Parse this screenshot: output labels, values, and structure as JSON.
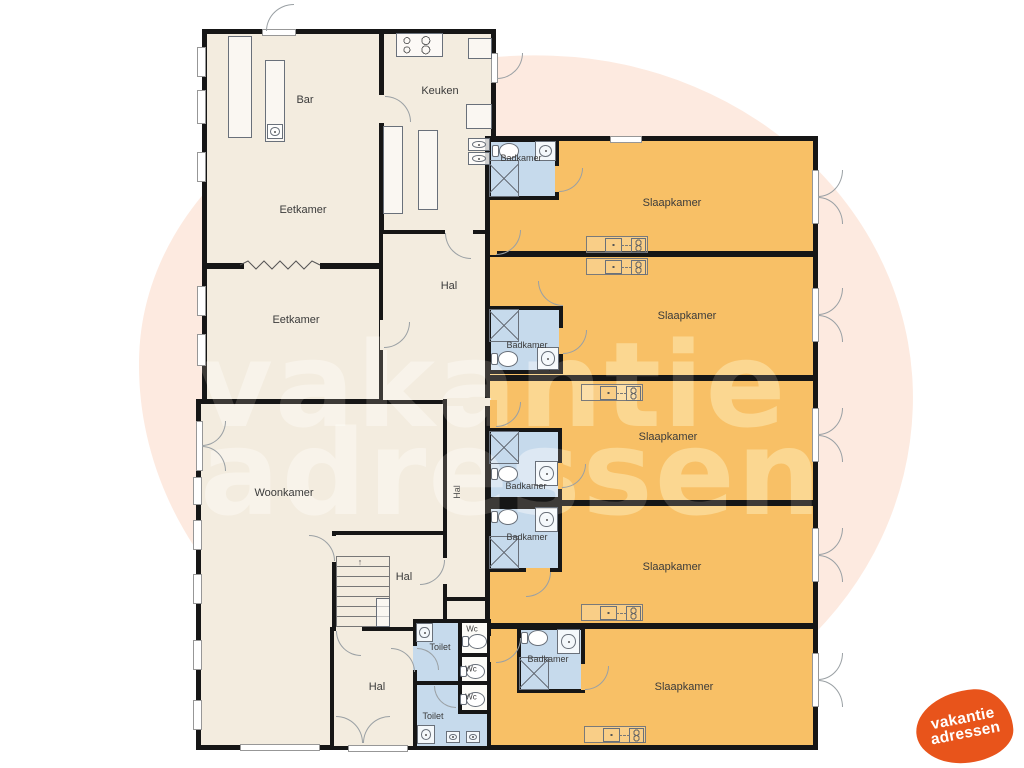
{
  "watermark": {
    "line1": "vakantie",
    "line2": "adressen"
  },
  "logo": {
    "line1": "vakantie",
    "line2": "adressen"
  },
  "colors": {
    "wall": "#161616",
    "floor": "#f3ecdf",
    "bedroom": "#f8c066",
    "bathroom": "#c6daec",
    "blob": "#fdeae0",
    "watermark": "#fff6ec",
    "logo": "#e8541b"
  },
  "rooms": {
    "bar": "Bar",
    "keuken": "Keuken",
    "eetkamer_boven": "Eetkamer",
    "eetkamer_onder": "Eetkamer",
    "woonkamer": "Woonkamer",
    "hal_centraal": "Hal",
    "hal_gang": "Hal",
    "hal_trap": "Hal",
    "hal_onder": "Hal",
    "toilet_boven": "Toilet",
    "toilet_onder": "Toilet"
  },
  "bedrooms": [
    {
      "label": "Slaapkamer"
    },
    {
      "label": "Slaapkamer"
    },
    {
      "label": "Slaapkamer"
    },
    {
      "label": "Slaapkamer"
    },
    {
      "label": "Slaapkamer"
    }
  ],
  "bathrooms": [
    {
      "label": "Badkamer"
    },
    {
      "label": "Badkamer"
    },
    {
      "label": "Badkamer"
    },
    {
      "label": "Badkamer"
    },
    {
      "label": "Badkamer"
    }
  ],
  "wcs": [
    {
      "label": "Wc"
    },
    {
      "label": "Wc"
    },
    {
      "label": "Wc"
    }
  ]
}
